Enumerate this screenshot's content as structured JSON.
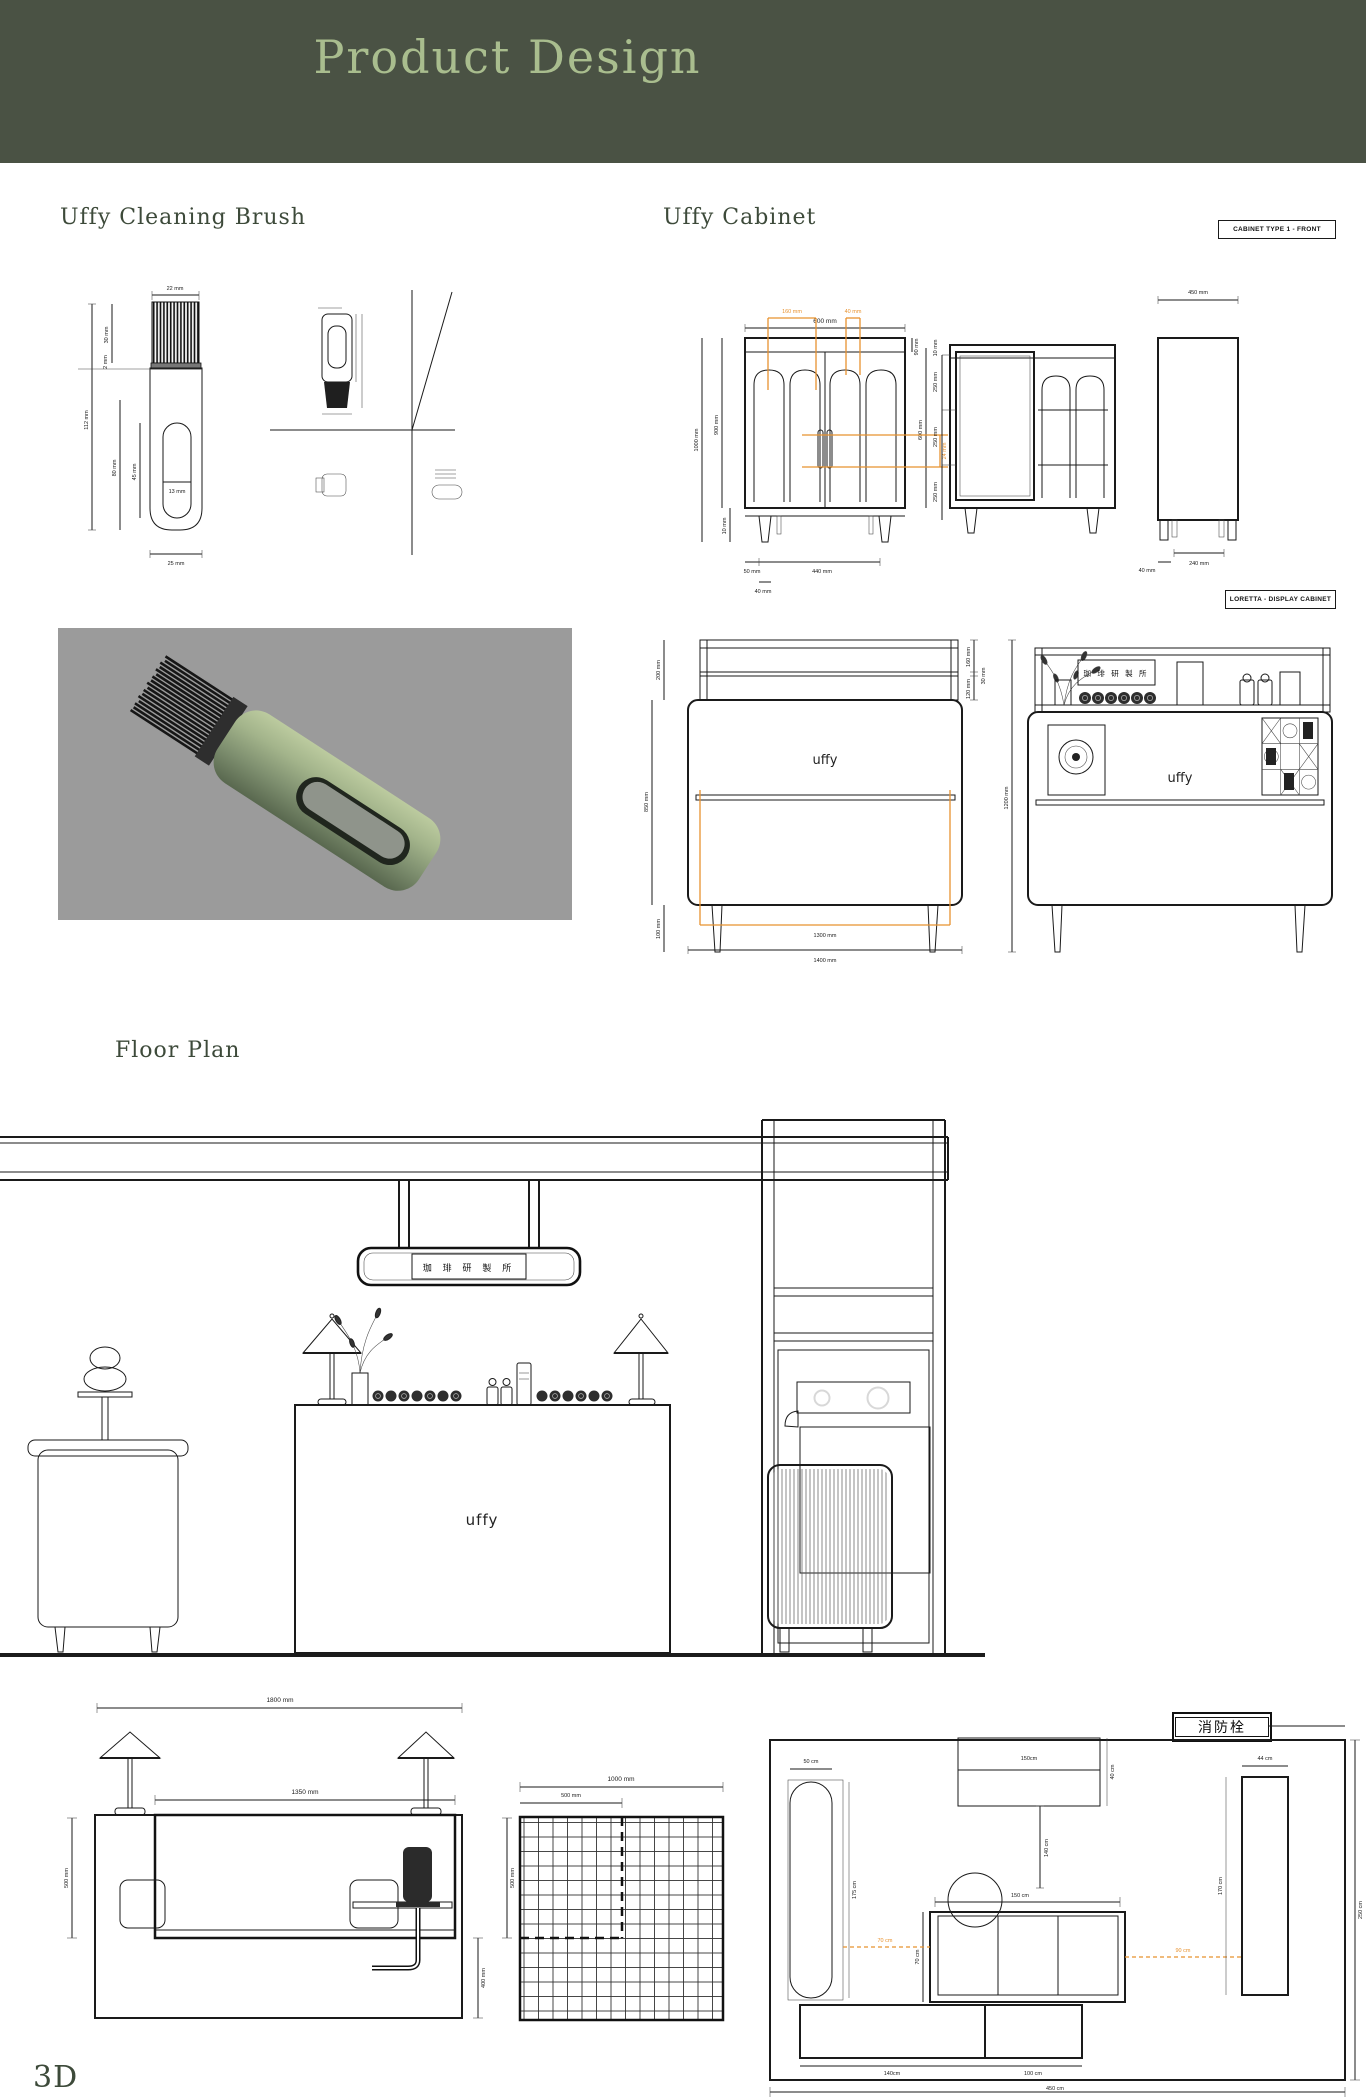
{
  "header": {
    "title": "Product Design"
  },
  "titles": {
    "brush": "Uffy Cleaning Brush",
    "cabinet": "Uffy Cabinet",
    "floor_plan": "Floor Plan",
    "footer": "3D"
  },
  "labels": {
    "cabinet_type": "CABINET TYPE 1 - FRONT",
    "display_cabinet": "LORETTA - DISPLAY CABINET",
    "fire_hydrant": "消防栓",
    "shop_sign": "珈 琲 研 製 所",
    "brand": "uffy"
  },
  "colors": {
    "header_bg": "#4a5244",
    "header_fg": "#a9bd8e",
    "accent_orange": "#e8922f",
    "render_bg": "#9b9b9b",
    "brush_green": "#93a681",
    "ink": "#1a1a1a"
  },
  "brush": {
    "dims": {
      "bristle_width": "22 mm",
      "total_height": "112 mm",
      "bristle_height": "30 mm",
      "collar": "2 mm",
      "handle": "80 mm",
      "slot_height": "45 mm",
      "slot_width": "13 mm",
      "body_width": "25 mm"
    }
  },
  "cabinet_front": {
    "dims": {
      "width": "600 mm",
      "door_panel": "160 mm",
      "gap": "40 mm",
      "height_total": "1000 mm",
      "height_body": "900 mm",
      "top_band": "90 mm",
      "door_height": "600 mm",
      "handle": "24 mm",
      "leg": "10 mm",
      "foot_offset": "50 mm",
      "foot_span": "440 mm",
      "foot_width": "40 mm"
    }
  },
  "cabinet_mid": {
    "dims": {
      "gap": "10 mm",
      "shelf1": "250 mm",
      "shelf2": "250 mm",
      "shelf3": "250 mm"
    }
  },
  "cabinet_side": {
    "dims": {
      "depth": "450 mm",
      "foot_span": "240 mm",
      "foot_offset": "40 mm"
    }
  },
  "display_cabinet": {
    "dims": {
      "top_height": "200 mm",
      "body_height": "850 mm",
      "leg_height": "100 mm",
      "shelf_top": "160 mm",
      "shelf_gap": "30 mm",
      "shelf_bottom": "120 mm",
      "height_total": "1200 mm",
      "inner_width": "1300 mm",
      "width_total": "1400 mm"
    }
  },
  "counter_elevation": {
    "dims": {
      "width_total": "1800 mm",
      "inner_width": "1350 mm",
      "height_upper_left": "500 mm",
      "height_upper_right": "500 mm",
      "height_lower": "400 mm"
    }
  },
  "tile_plan": {
    "dims": {
      "width": "1000 mm",
      "inner": "500 mm"
    }
  },
  "floor_plan": {
    "dims": {
      "capsule_width": "50 cm",
      "capsule_height": "175 cm",
      "wall_unit": "150cm",
      "wall_unit_depth": "40 cm",
      "drop": "140 cm",
      "counter_width": "150 cm",
      "counter_depth": "70 cm",
      "gap_left": "70 cm",
      "gap_right": "90 cm",
      "low_unit_left": "140cm",
      "low_unit_right": "100 cm",
      "tall_width": "44 cm",
      "tall_height": "170 cm",
      "room_depth": "250 cm",
      "room_width": "450 cm"
    }
  }
}
